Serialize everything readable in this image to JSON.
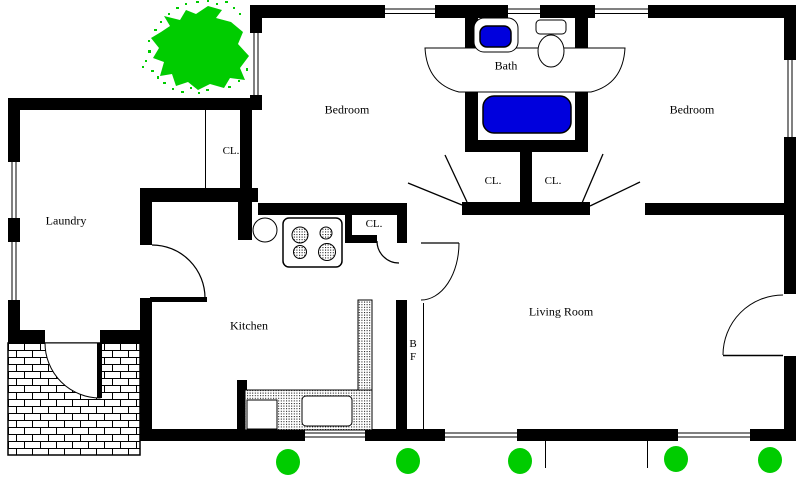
{
  "rooms": {
    "bedroom_left": "Bedroom",
    "bedroom_right": "Bedroom",
    "bath": "Bath",
    "laundry": "Laundry",
    "kitchen": "Kitchen",
    "living": "Living Room"
  },
  "closets": {
    "laundry_cl": "CL.",
    "kitchen_cl": "CL.",
    "hall_cl_left": "CL.",
    "hall_cl_right": "CL."
  },
  "labels": {
    "bifold_b": "B",
    "bifold_f": "F"
  },
  "colors": {
    "wall_black": "#000000",
    "fixture_blue": "#0000dd",
    "shrub_green": "#00cc00",
    "background": "#ffffff"
  }
}
